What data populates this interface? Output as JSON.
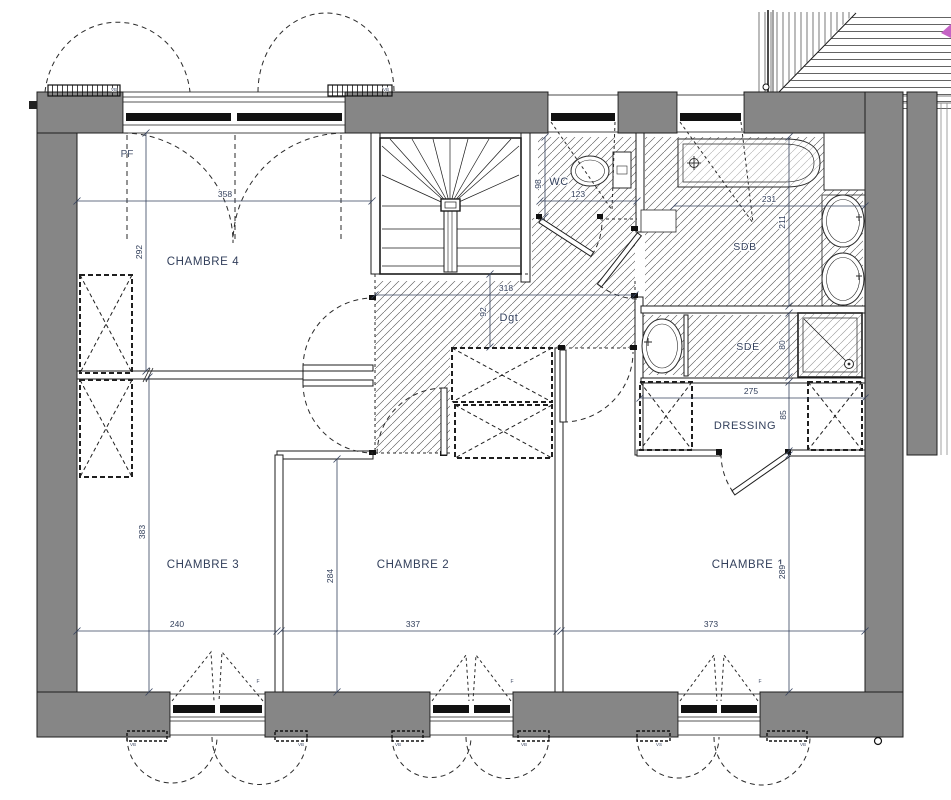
{
  "document": {
    "kind_label": "floor-plan-level-1"
  },
  "colors": {
    "wall_grey": "#868686",
    "line_black": "#1d1d1d",
    "text_navy": "#33405c",
    "magenta_marker": "#c563c5"
  },
  "rooms": [
    {
      "id": "chambre-4",
      "label": "CHAMBRE 4",
      "x": 203,
      "y": 265,
      "size": 11.5
    },
    {
      "id": "chambre-3",
      "label": "CHAMBRE 3",
      "x": 203,
      "y": 568,
      "size": 11.5
    },
    {
      "id": "chambre-2",
      "label": "CHAMBRE 2",
      "x": 413,
      "y": 568,
      "size": 11.5
    },
    {
      "id": "chambre-1",
      "label": "CHAMBRE 1",
      "x": 748,
      "y": 568,
      "size": 11.5
    },
    {
      "id": "wc",
      "label": "WC",
      "x": 559,
      "y": 185,
      "size": 11
    },
    {
      "id": "sdb",
      "label": "SDB",
      "x": 745,
      "y": 250,
      "size": 10.5
    },
    {
      "id": "sde",
      "label": "SDE",
      "x": 748,
      "y": 350,
      "size": 10.5
    },
    {
      "id": "dressing",
      "label": "DRESSING",
      "x": 745,
      "y": 429,
      "size": 11
    },
    {
      "id": "degagement",
      "label": "Dgt",
      "x": 509,
      "y": 321,
      "size": 11
    }
  ],
  "dimensions": [
    {
      "value": "358",
      "x": 225,
      "y": 197,
      "rotate": false
    },
    {
      "value": "292",
      "x": 142,
      "y": 252,
      "rotate": true
    },
    {
      "value": "123",
      "x": 578,
      "y": 197,
      "rotate": false
    },
    {
      "value": "98",
      "x": 541,
      "y": 184,
      "rotate": true
    },
    {
      "value": "231",
      "x": 769,
      "y": 202,
      "rotate": false
    },
    {
      "value": "211",
      "x": 785,
      "y": 222,
      "rotate": true
    },
    {
      "value": "318",
      "x": 506,
      "y": 291,
      "rotate": false
    },
    {
      "value": "92",
      "x": 486,
      "y": 312,
      "rotate": true
    },
    {
      "value": "80",
      "x": 785,
      "y": 345,
      "rotate": true
    },
    {
      "value": "275",
      "x": 751,
      "y": 394,
      "rotate": false
    },
    {
      "value": "85",
      "x": 786,
      "y": 415,
      "rotate": true
    },
    {
      "value": "383",
      "x": 145,
      "y": 532,
      "rotate": true
    },
    {
      "value": "284",
      "x": 333,
      "y": 576,
      "rotate": true
    },
    {
      "value": "289",
      "x": 785,
      "y": 572,
      "rotate": true
    },
    {
      "value": "240",
      "x": 177,
      "y": 627,
      "rotate": false
    },
    {
      "value": "337",
      "x": 413,
      "y": 627,
      "rotate": false
    },
    {
      "value": "373",
      "x": 711,
      "y": 627,
      "rotate": false
    }
  ],
  "annotations": [
    {
      "text": "PF",
      "x": 127,
      "y": 157,
      "size": 10
    },
    {
      "text": "VB",
      "x": 114,
      "y": 91,
      "size": 4.5
    },
    {
      "text": "VB",
      "x": 386,
      "y": 91,
      "size": 4.5
    },
    {
      "text": "F",
      "x": 258,
      "y": 683,
      "size": 5
    },
    {
      "text": "F",
      "x": 512,
      "y": 683,
      "size": 5
    },
    {
      "text": "F",
      "x": 760,
      "y": 683,
      "size": 5
    },
    {
      "text": "VB",
      "x": 133,
      "y": 746,
      "size": 4.5
    },
    {
      "text": "VB",
      "x": 301,
      "y": 746,
      "size": 4.5
    },
    {
      "text": "VB",
      "x": 398,
      "y": 746,
      "size": 4.5
    },
    {
      "text": "VB",
      "x": 524,
      "y": 746,
      "size": 4.5
    },
    {
      "text": "VS",
      "x": 659,
      "y": 746,
      "size": 4.5
    },
    {
      "text": "VB",
      "x": 803,
      "y": 746,
      "size": 4.5
    }
  ]
}
